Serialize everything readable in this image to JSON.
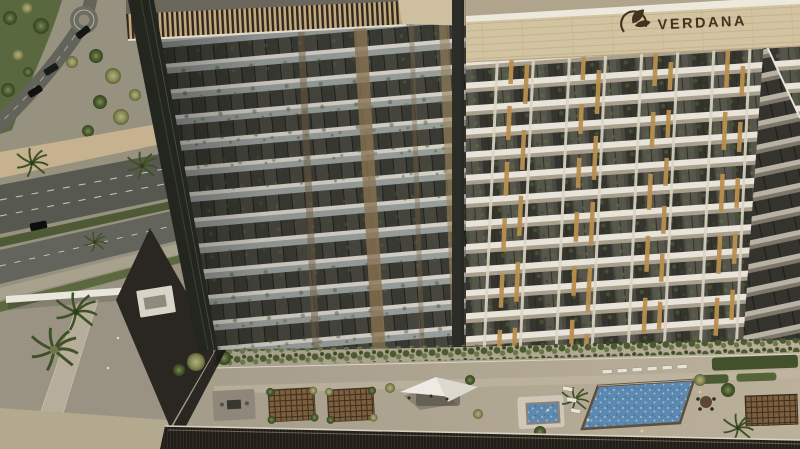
{
  "branding": {
    "logo_text": "VERDANA",
    "logo_icon": "verdana-leaf-icon",
    "logo_color": "#42331f",
    "parapet_color": "#d2c3a1"
  },
  "scene": {
    "type": "aerial-architectural-rendering",
    "buildings": {
      "left_tower": {
        "facade": "glass-balcony-tower",
        "roof": "timber-louvre-band",
        "floors_visible": 12
      },
      "right_tower": {
        "facade": "cream-grid-balconies",
        "accents": "gold-louvres",
        "floors_visible": 13,
        "logo_on_parapet": true
      }
    },
    "amenity_deck": {
      "main_pool": true,
      "kids_pool": true,
      "shade_sail": true,
      "pergolas": 3,
      "sun_loungers": 9,
      "garden_planters": true
    },
    "ground": {
      "roads": 3,
      "roundabout": true,
      "cars": 4,
      "palm_trees": 6,
      "entrance_canopy": true
    }
  },
  "palette": {
    "parapet": "#d2c3a1",
    "slab_white": "#e8e4d9",
    "glass_dark": "#3b3b35",
    "gold_louvre": "#b98f4f",
    "bronze_accent": "#8a7352",
    "pool_water": "#5d89b0",
    "greenery": "#4f5e33",
    "deck": "#ada391",
    "road": "#57584f",
    "sand": "#c6b28e",
    "podium_dark": "#1f1d19"
  }
}
